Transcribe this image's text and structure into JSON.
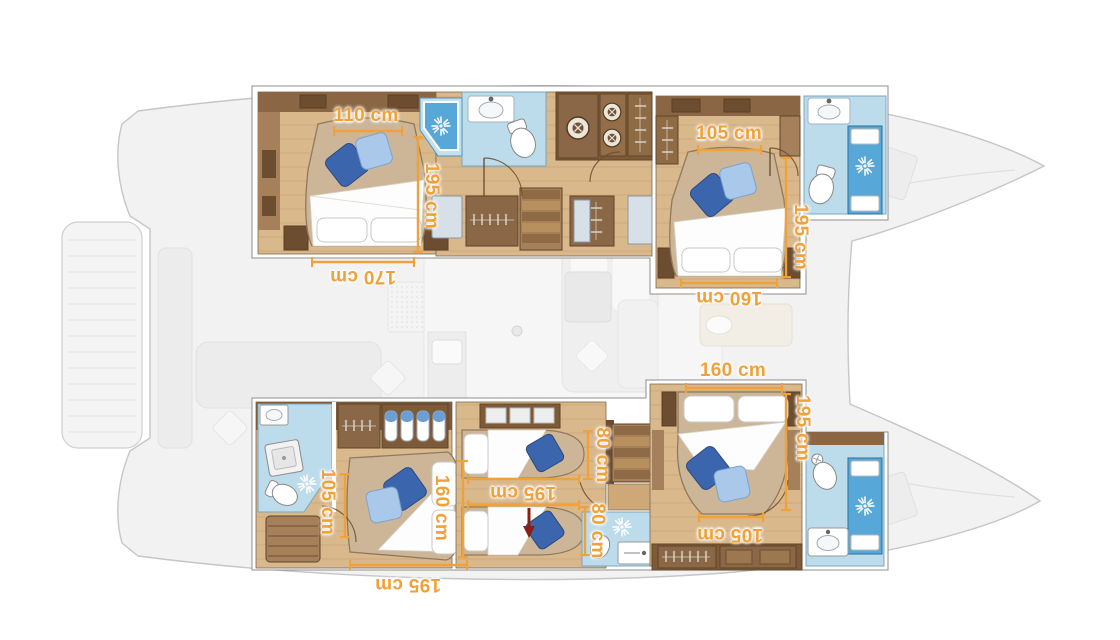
{
  "plan": {
    "type": "catamaran-lower-deck-floor-plan",
    "unit": "cm"
  },
  "dimensions": {
    "top_left_cabin": {
      "bed_foot_width": "110 cm",
      "bed_length": "195 cm",
      "bed_head_width": "170 cm"
    },
    "top_right_cabin": {
      "bed_foot_width": "105 cm",
      "bed_length": "195 cm",
      "bed_head_width": "160 cm"
    },
    "bottom_left_cabin": {
      "bed_foot_width": "105 cm",
      "bed_head_width": "160 cm",
      "bed_length": "195 cm"
    },
    "middle_cabin": {
      "bed1_width": "80 cm",
      "bed2_width": "80 cm",
      "bed_length": "195 cm"
    },
    "bottom_right_cabin": {
      "bed_head_width": "160 cm",
      "bed_length": "195 cm",
      "bed_foot_width": "105 cm"
    }
  },
  "colors": {
    "dimension_accent": "#f0a23a",
    "wood_floor": "#d9b88c",
    "wood_dark": "#7d5a38",
    "wood_mid": "#8a6746",
    "bathroom_floor": "#bcdcec",
    "shower_blue": "#57a8d8",
    "pillow_dark_blue": "#3b66ad",
    "pillow_light_blue": "#a9c8ea",
    "arrow_red": "#8c1f14",
    "ghost_fill": "#f2f2f2",
    "ghost_stroke": "#c6c6c6"
  },
  "icons": {
    "shower_light": "starburst-icon",
    "washing_machine": "washer-drum-icon",
    "clothes_hanger": "hanger-icon",
    "towel": "rolled-towel-icon",
    "stairs": "stairs-icon"
  }
}
